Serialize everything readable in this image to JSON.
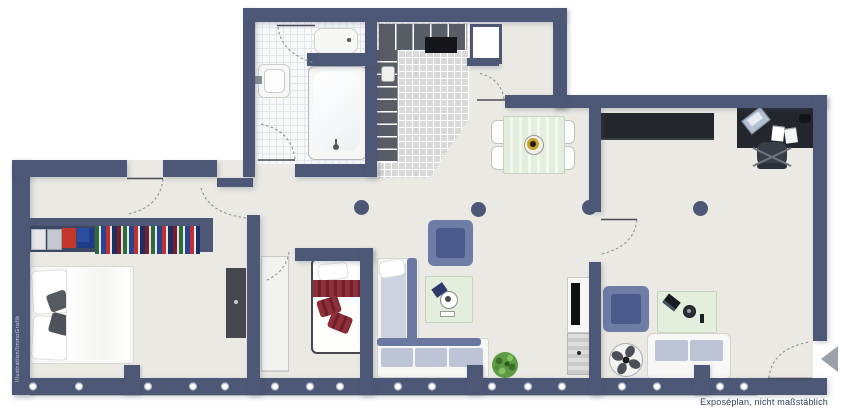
{
  "labels": {
    "disclaimer": "Exposéplan, nicht maßstäblich",
    "watermark": "Illustration/ImmoGrafik"
  },
  "colors": {
    "wall": "#4d5776",
    "floor": "#eae9e4",
    "bathtile": "#f6f8f9",
    "grid": "#e2e6ea",
    "halltile": "#d8d9d8",
    "slate": "#6a78a2",
    "slatedark": "#4d5b8c",
    "armchair": "#6e7ca6",
    "pad": "#ccd3df",
    "cushion": "#bcc4d6",
    "tablegreen": "#e3eedd",
    "red": "#8e2f3a",
    "reddark": "#6f1f2b",
    "gold": "#c9a22a",
    "plant": "#5d9c44",
    "dark": "#23262c",
    "shelf": "#585d66",
    "arc": "#8a8f98",
    "leaf": "#4a4a55",
    "textc": "#323c5a",
    "arrow": "#9ba1a9",
    "bandline": "#c3c8d0",
    "cream": "#f7f7f5"
  },
  "furniture_items": [
    "bathtub",
    "washbasin",
    "toilet",
    "entry-shelf",
    "entry-rack",
    "storage-duct",
    "dining-table",
    "dining-chair",
    "fruit-bowl",
    "sideboard",
    "desk",
    "laptop",
    "papers",
    "office-chair",
    "double-bed",
    "clothes-rack",
    "folded-clothes",
    "hanging-clothes",
    "cabinet",
    "wardrobe",
    "single-bed",
    "l-sofa",
    "armchair",
    "coffee-table",
    "tv-lowboard",
    "plant",
    "floor-fan",
    "two-seat-sofa",
    "structural-column",
    "window-band",
    "entrance-arrow"
  ]
}
